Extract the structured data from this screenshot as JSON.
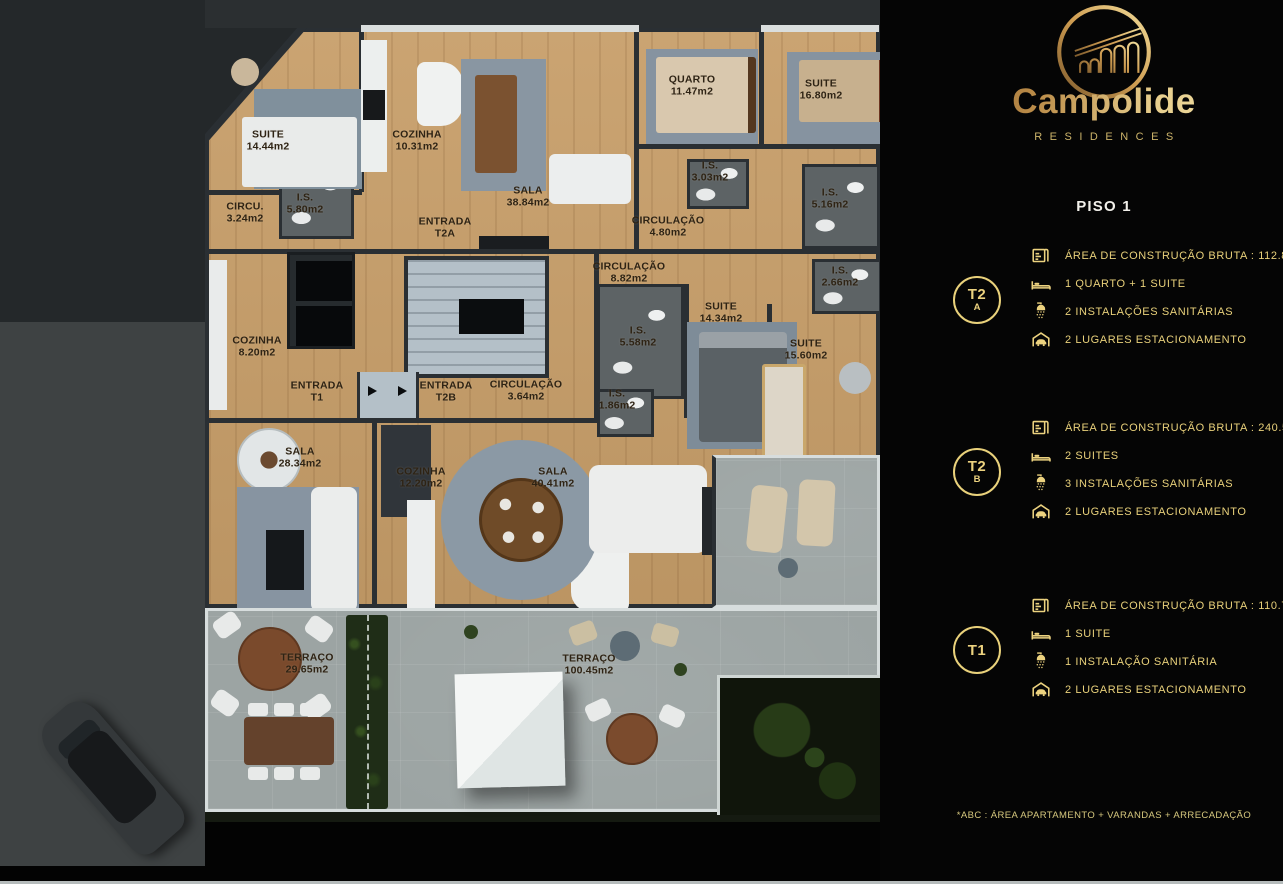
{
  "brand": {
    "name": "Campolide",
    "subtitle": "RESIDENCES",
    "logo_icon": "aqueduct-arches-logo"
  },
  "panel": {
    "floor_title": "PISO 1",
    "units": [
      {
        "id": "T2A",
        "badge_line1": "T2",
        "badge_line2": "A",
        "specs": [
          {
            "icon": "blueprint-icon",
            "text": "ÁREA DE CONSTRUÇÃO BRUTA :  112.85 м2*"
          },
          {
            "icon": "bed-icon",
            "text": "1 QUARTO + 1 SUITE"
          },
          {
            "icon": "shower-icon",
            "text": "2 INSTALAÇÕES SANITÁRIAS"
          },
          {
            "icon": "garage-icon",
            "text": "2 LUGARES ESTACIONAMENTO"
          }
        ]
      },
      {
        "id": "T2B",
        "badge_line1": "T2",
        "badge_line2": "B",
        "specs": [
          {
            "icon": "blueprint-icon",
            "text": "ÁREA DE CONSTRUÇÃO BRUTA :  240.55 м2*"
          },
          {
            "icon": "bed-icon",
            "text": "2 SUITES"
          },
          {
            "icon": "shower-icon",
            "text": "3 INSTALAÇÕES SANITÁRIAS"
          },
          {
            "icon": "garage-icon",
            "text": "2 LUGARES ESTACIONAMENTO"
          }
        ]
      },
      {
        "id": "T1",
        "badge_line1": "T1",
        "badge_line2": "",
        "specs": [
          {
            "icon": "blueprint-icon",
            "text": "ÁREA DE CONSTRUÇÃO BRUTA :  110.70м2*"
          },
          {
            "icon": "bed-icon",
            "text": "1 SUITE"
          },
          {
            "icon": "shower-icon",
            "text": "1 INSTALAÇÃO SANITÁRIA"
          },
          {
            "icon": "garage-icon",
            "text": "2 LUGARES ESTACIONAMENTO"
          }
        ]
      }
    ],
    "footnote": "*ABC :  ÁREA APARTAMENTO + VARANDAS + ARRECADAÇÃO"
  },
  "plan": {
    "rooms": [
      {
        "label": "SUITE",
        "area": "14.44m2"
      },
      {
        "label": "COZINHA",
        "area": "10.31m2"
      },
      {
        "label": "SALA",
        "area": "38.84m2"
      },
      {
        "label": "QUARTO",
        "area": "11.47m2"
      },
      {
        "label": "SUITE",
        "area": "16.80m2"
      },
      {
        "label": "I.S.",
        "area": "5.80m2"
      },
      {
        "label": "CIRCU.",
        "area": "3.24m2"
      },
      {
        "label": "ENTRADA",
        "area": "T2A"
      },
      {
        "label": "CIRCULAÇÃO",
        "area": "4.80m2"
      },
      {
        "label": "I.S.",
        "area": "3.03m2"
      },
      {
        "label": "I.S.",
        "area": "5.16m2"
      },
      {
        "label": "CIRCULAÇÃO",
        "area": "8.82m2"
      },
      {
        "label": "I.S.",
        "area": "2.66m2"
      },
      {
        "label": "SUITE",
        "area": "14.34m2"
      },
      {
        "label": "I.S.",
        "area": "5.58m2"
      },
      {
        "label": "SUITE",
        "area": "15.60m2"
      },
      {
        "label": "COZINHA",
        "area": "8.20m2"
      },
      {
        "label": "ENTRADA",
        "area": "T1"
      },
      {
        "label": "ENTRADA",
        "area": "T2B"
      },
      {
        "label": "CIRCULAÇÃO",
        "area": "3.64m2"
      },
      {
        "label": "I.S.",
        "area": "1.86m2"
      },
      {
        "label": "SALA",
        "area": "28.34m2"
      },
      {
        "label": "COZINHA",
        "area": "12.20m2"
      },
      {
        "label": "SALA",
        "area": "40.41m2"
      },
      {
        "label": "TERRAÇO",
        "area": "29.65m2"
      },
      {
        "label": "TERRAÇO",
        "area": "100.45m2"
      }
    ]
  },
  "colors": {
    "gold": "#e9d17b",
    "panel_bg": "#050505",
    "wood": "#c79e69",
    "wall": "#2a2f33",
    "terrace": "#9ca4a3",
    "rug": "#8895a1",
    "road": "#3e4243",
    "backdrop": "#24282b",
    "garden": "#10150b",
    "core": "#b4c0c8"
  }
}
